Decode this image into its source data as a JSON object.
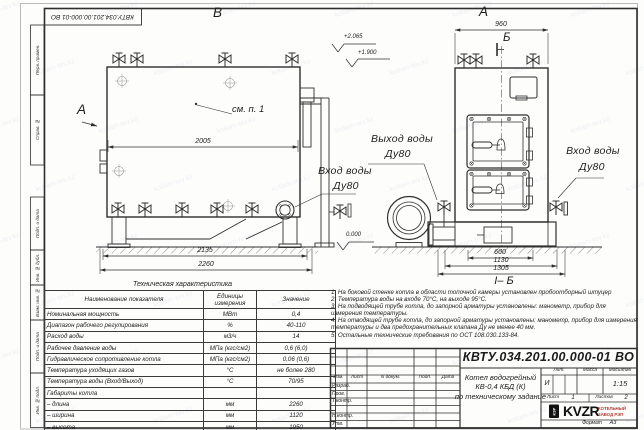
{
  "watermark": "kotlam-tev.kz",
  "stamp_top": "КВТУ.034.201.00.000-01 ВО",
  "margin_labels": [
    "Перв. примен.",
    "Справ. №",
    "Подп. и дата",
    "Инв. № дубл.",
    "Взам. инв. №",
    "Подп. и дата",
    "Инв. № подл."
  ],
  "views": {
    "left": {
      "letter": "В",
      "direction_letter": "А",
      "see_note": "см. п. 1",
      "dim_top": "2005",
      "dim_mid": "2135",
      "dim_bottom": "2260",
      "elev_top": "+2.065",
      "elev_mid": "+1.900",
      "elev_zero": "0.000"
    },
    "right": {
      "letter": "А",
      "section_letter": "Б",
      "section_title": "І– Б",
      "dim_top": "960",
      "dim_b1": "660",
      "dim_b2": "1130",
      "dim_b3": "1305"
    },
    "pipes": {
      "outlet_label": "Выход воды",
      "outlet_dn": "Ду80",
      "inlet_left_label": "Вход воды",
      "inlet_left_dn": "Ду80",
      "inlet_right_label": "Вход воды",
      "inlet_right_dn": "Ду80"
    }
  },
  "spec_table": {
    "title": "Техническая характеристика",
    "headers": [
      "Наименование показателя",
      "Единицы измерения",
      "Значение"
    ],
    "rows": [
      [
        "Номинальная мощность",
        "МВт",
        "0,4"
      ],
      [
        "Диапазон рабочего регулирования",
        "%",
        "40-110"
      ],
      [
        "Расход воды",
        "м3/ч",
        "14"
      ],
      [
        "Рабочее давление воды",
        "МПа (кгс/см2)",
        "0,6 (6,0)"
      ],
      [
        "Гидравлическое сопротивление котла",
        "МПа (кгс/см2)",
        "0,06 (0,6)"
      ],
      [
        "Температура уходящих газов",
        "°С",
        "не более 280"
      ],
      [
        "Температура воды (Вход/Выход)",
        "°С",
        "70/95"
      ],
      [
        "Габариты котла",
        "",
        ""
      ],
      [
        "– длина",
        "мм",
        "2260"
      ],
      [
        "– ширина",
        "мм",
        "1120"
      ],
      [
        "– высота",
        "мм",
        "1950"
      ]
    ]
  },
  "notes": [
    "1. На боковой стенке котла в области топочной камеры установлен пробоотборный штуцер",
    "2. Температура воды на входе 70°С, на выходе 95°С.",
    "3. На подводящей трубе котла, до запорной арматуры установлены: манометр, прибор для измерения температуры.",
    "4. На отводящей трубе котла, до запорной арматуры установлены: манометр, прибор для измерения температуры и два предохранительных клапана Ду не менее 40 мм.",
    "5. Остальные технические требования по ОСТ 108.030.133-84."
  ],
  "title_block": {
    "doc_number": "КВТУ.034.201.00.000-01 ВО",
    "name_line1": "Котел водогрейный",
    "name_line2": "КВ-0,4 КБД (К)",
    "name_line3": "по техническому задание",
    "col_izm": "Изм.",
    "col_list": "Лист",
    "col_doc": "N докум.",
    "col_podp": "Подп.",
    "col_data": "Дата",
    "row_razrab": "Разраб.",
    "row_prov": "Пров.",
    "row_tkontr": "Т.контр.",
    "row_nkontr": "Н.контр.",
    "row_utv": "Утв.",
    "lit_label": "Лит.",
    "lit_value": "И",
    "mass_label": "Масса",
    "scale_label": "Масштаб",
    "scale_value": "1:15",
    "sheet_label": "Лист",
    "sheet_value": "1",
    "sheets_label": "Листов",
    "sheets_value": "2",
    "logo_text": "KVZR",
    "logo_box_text": "КЗР",
    "logo_sub1": "КОТЕЛЬНЫЙ",
    "logo_sub2": "ЗАВОД РЭП",
    "format_label": "Формат",
    "format_value": "А3"
  }
}
